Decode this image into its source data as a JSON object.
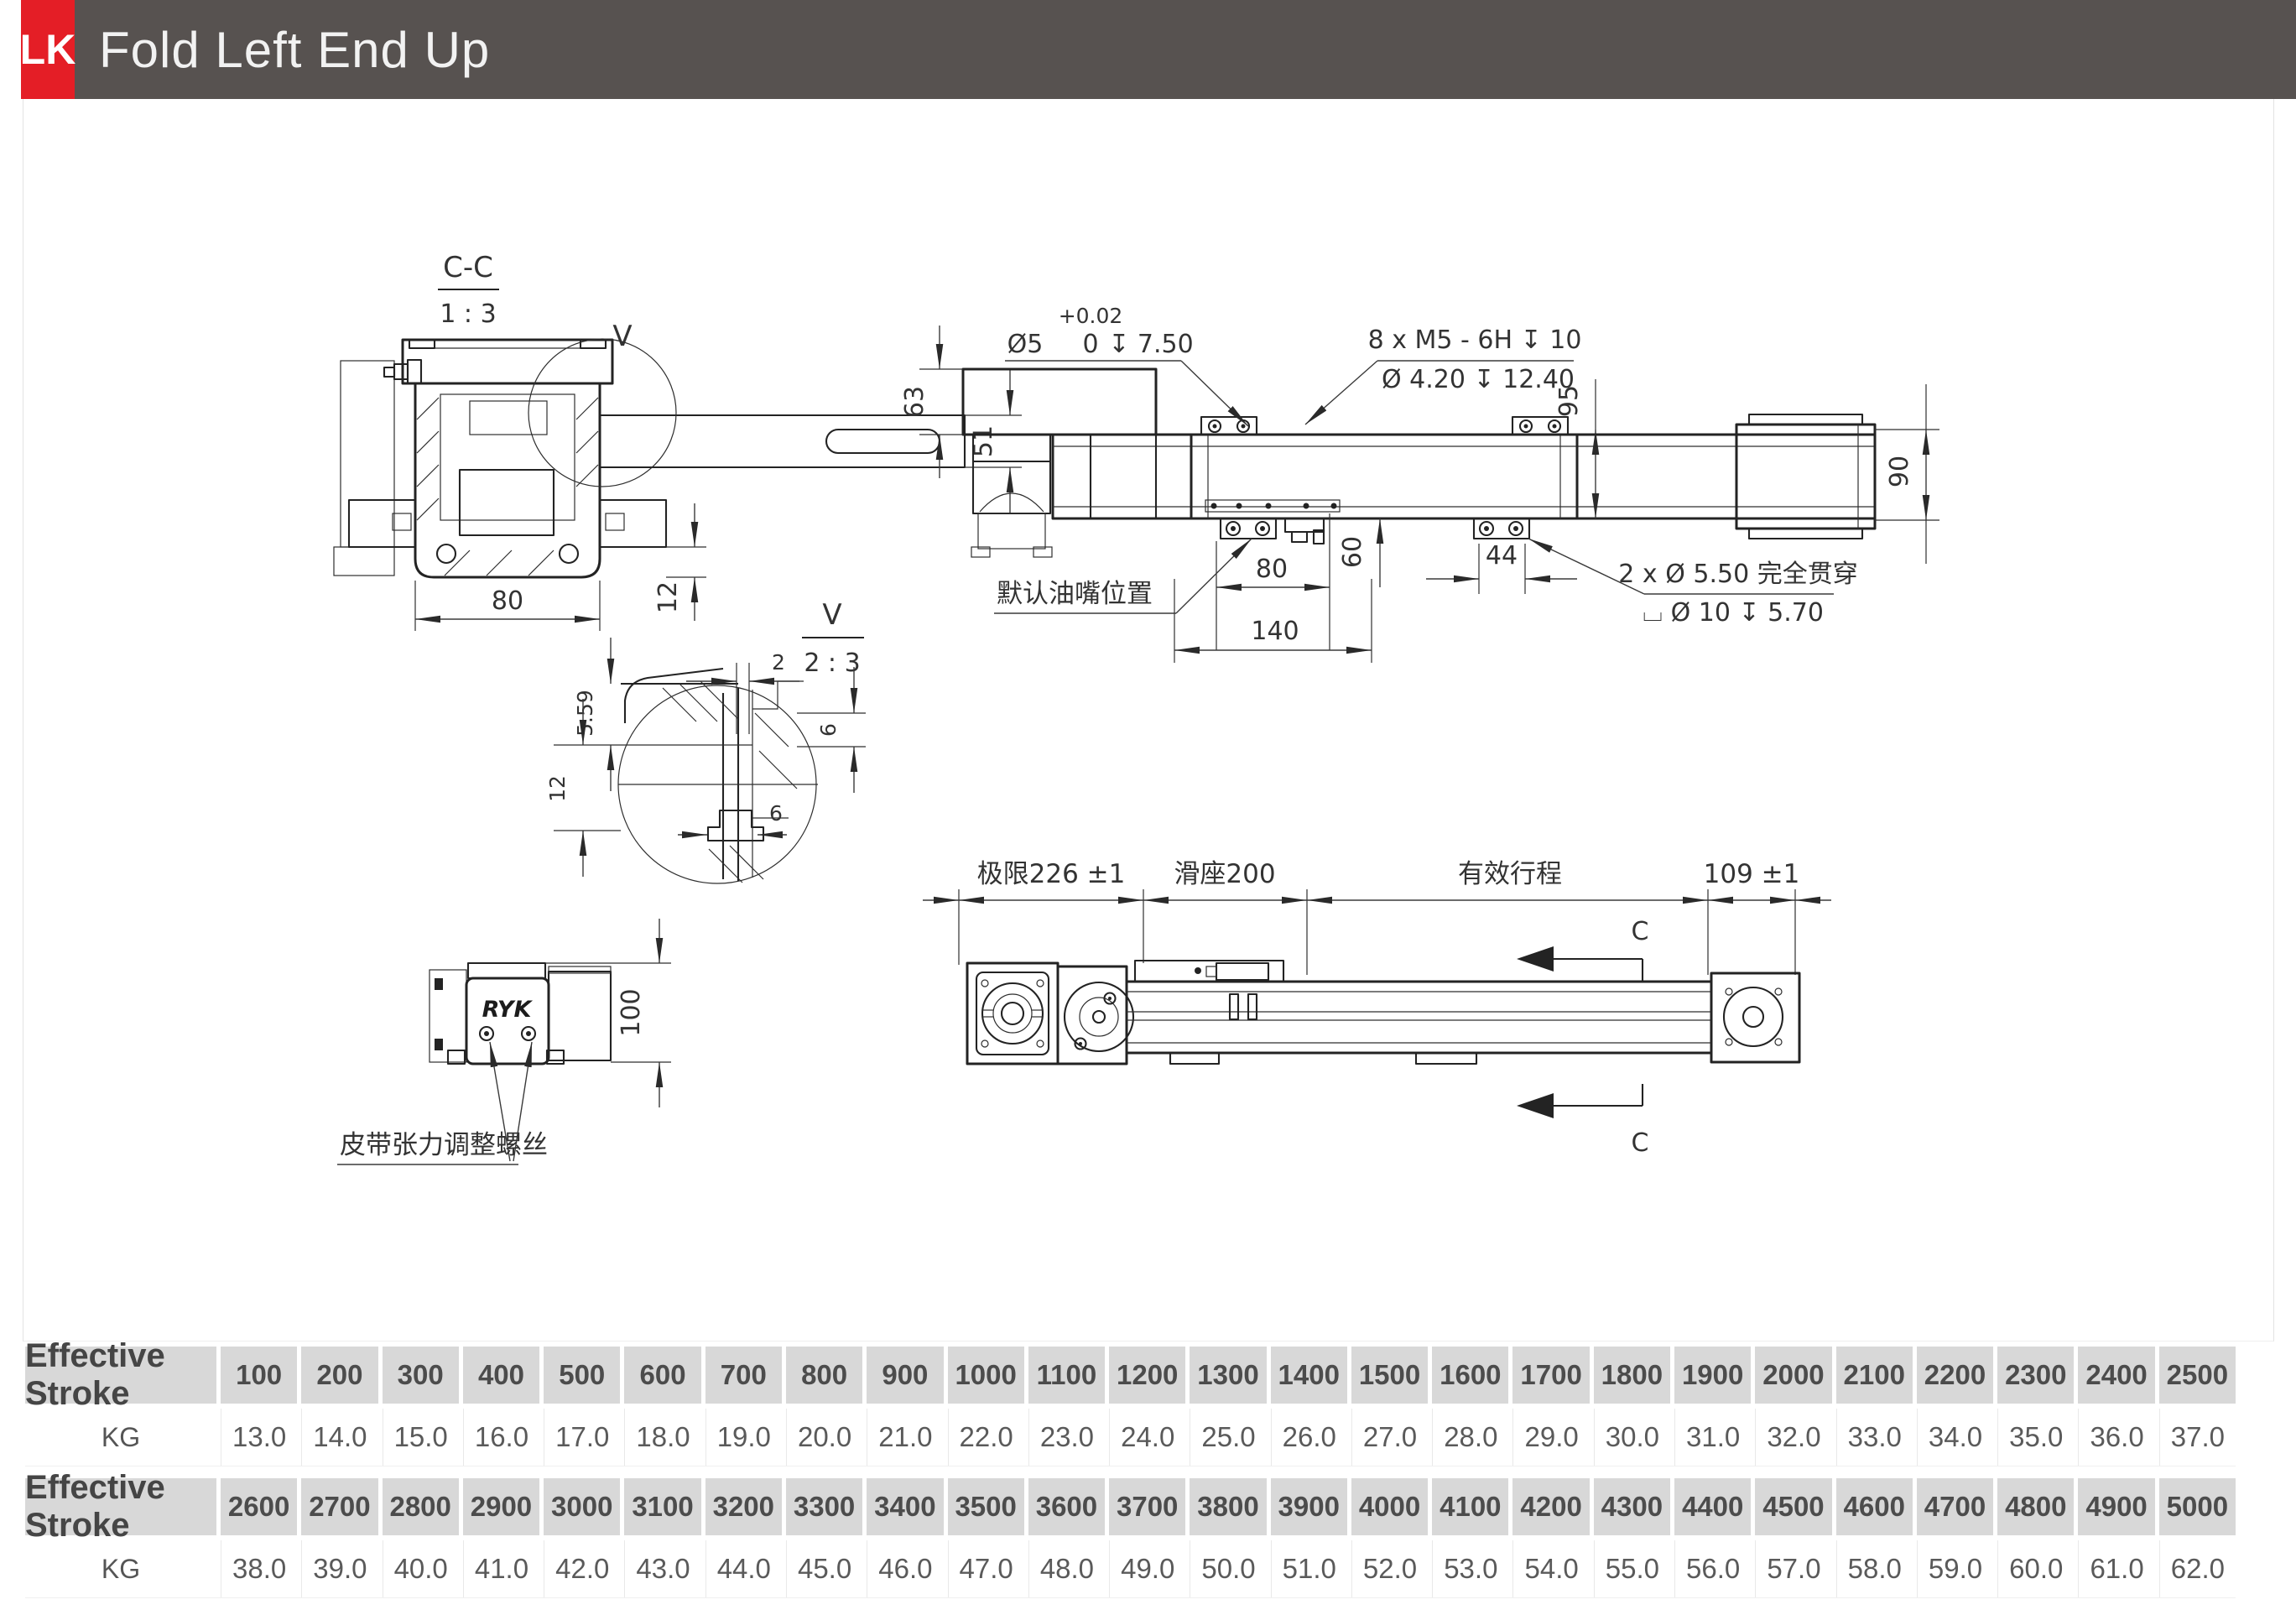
{
  "header": {
    "badge": "LK",
    "title": "Fold Left End Up"
  },
  "colors": {
    "accent_red": "#e41e26",
    "header_bar": "#575250",
    "table_header_bg": "#d8d8d8"
  },
  "drawings": {
    "section_cc": {
      "title": "C-C",
      "scale": "1 : 3",
      "detail_mark": "V",
      "dim_width": "80",
      "dim_tab": "12",
      "dim_arm": "51"
    },
    "detail_v": {
      "title": "V",
      "scale": "2 : 3",
      "dim_gap": "2",
      "dim_lip": "5.59",
      "dim_side": "12",
      "dim_step": "6",
      "dim_inner": "6"
    },
    "motor_view": {
      "logo": "RYK",
      "dim_height": "100",
      "label_tension_screws": "皮带张力调整螺丝"
    },
    "top_view": {
      "dim_motor_height": "63",
      "pin_callout": {
        "dia": "Ø5",
        "tol_upper": "+0.02",
        "tol_lower": "0",
        "depth": "↧ 7.50"
      },
      "thread_callout": {
        "line1": "8 x M5 - 6H ↧ 10",
        "line2": "Ø 4.20 ↧ 12.40"
      },
      "dim_95": "95",
      "dim_90": "90",
      "dim_60": "60",
      "dim_80": "80",
      "dim_140": "140",
      "dim_44": "44",
      "label_grease": "默认油嘴位置",
      "through_callout": {
        "line1": "2 x Ø 5.50 完全贯穿",
        "line2": "⌴ Ø 10 ↧ 5.70"
      }
    },
    "bottom_view": {
      "dim_limit": "极限226 ±1",
      "dim_carriage": "滑座200",
      "dim_stroke": "有效行程",
      "dim_end": "109 ±1",
      "section_mark": "C"
    }
  },
  "tables": [
    {
      "header_label": "Effective Stroke",
      "strokes": [
        "100",
        "200",
        "300",
        "400",
        "500",
        "600",
        "700",
        "800",
        "900",
        "1000",
        "1100",
        "1200",
        "1300",
        "1400",
        "1500",
        "1600",
        "1700",
        "1800",
        "1900",
        "2000",
        "2100",
        "2200",
        "2300",
        "2400",
        "2500"
      ],
      "row_label": "KG",
      "values": [
        "13.0",
        "14.0",
        "15.0",
        "16.0",
        "17.0",
        "18.0",
        "19.0",
        "20.0",
        "21.0",
        "22.0",
        "23.0",
        "24.0",
        "25.0",
        "26.0",
        "27.0",
        "28.0",
        "29.0",
        "30.0",
        "31.0",
        "32.0",
        "33.0",
        "34.0",
        "35.0",
        "36.0",
        "37.0"
      ]
    },
    {
      "header_label": "Effective Stroke",
      "strokes": [
        "2600",
        "2700",
        "2800",
        "2900",
        "3000",
        "3100",
        "3200",
        "3300",
        "3400",
        "3500",
        "3600",
        "3700",
        "3800",
        "3900",
        "4000",
        "4100",
        "4200",
        "4300",
        "4400",
        "4500",
        "4600",
        "4700",
        "4800",
        "4900",
        "5000"
      ],
      "row_label": "KG",
      "values": [
        "38.0",
        "39.0",
        "40.0",
        "41.0",
        "42.0",
        "43.0",
        "44.0",
        "45.0",
        "46.0",
        "47.0",
        "48.0",
        "49.0",
        "50.0",
        "51.0",
        "52.0",
        "53.0",
        "54.0",
        "55.0",
        "56.0",
        "57.0",
        "58.0",
        "59.0",
        "60.0",
        "61.0",
        "62.0"
      ]
    }
  ]
}
